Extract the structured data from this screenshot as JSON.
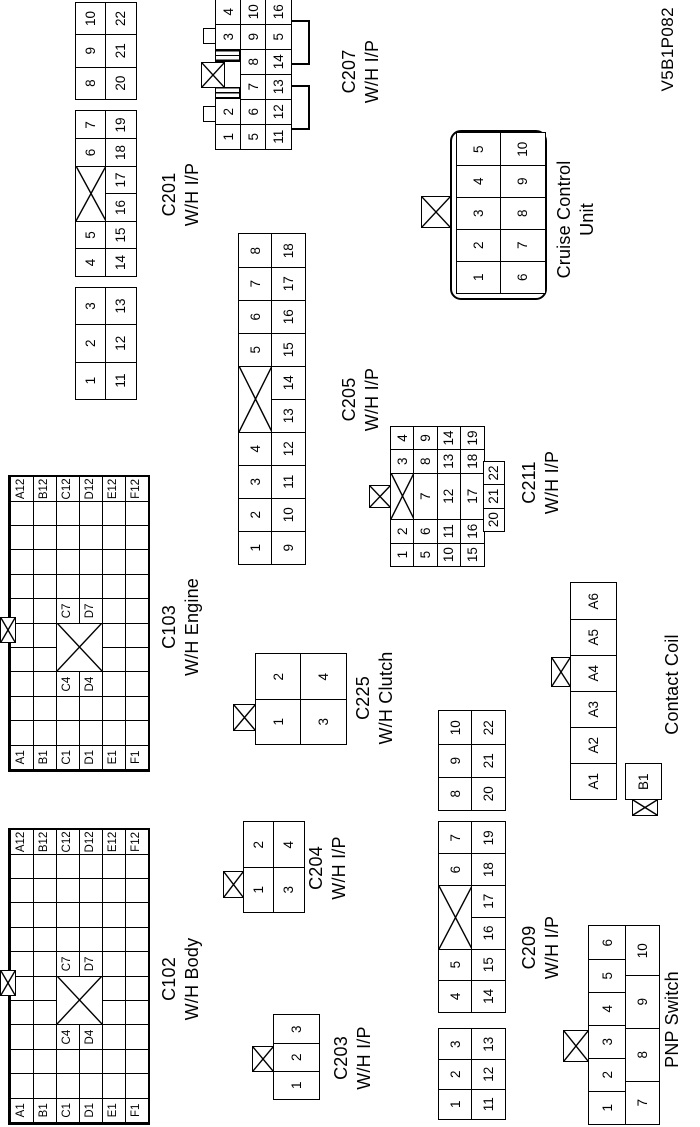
{
  "code": "V5B1P082",
  "connectors": {
    "c102": {
      "name": "C102",
      "sub": "W/H Body",
      "type": "grid",
      "cols": 12,
      "rows": 6,
      "cw": 24.4,
      "ch": 23,
      "cross": {
        "r": 2,
        "c": 4,
        "rs": 2,
        "cs": 2
      },
      "labels": [
        [
          0,
          0,
          "A1"
        ],
        [
          1,
          0,
          "B1"
        ],
        [
          2,
          0,
          "C1"
        ],
        [
          3,
          0,
          "D1"
        ],
        [
          4,
          0,
          "E1"
        ],
        [
          5,
          0,
          "F1"
        ],
        [
          0,
          11,
          "A12"
        ],
        [
          1,
          11,
          "B12"
        ],
        [
          2,
          11,
          "C12"
        ],
        [
          3,
          11,
          "D12"
        ],
        [
          4,
          11,
          "E12"
        ],
        [
          5,
          11,
          "F12"
        ],
        [
          2,
          3,
          "C4"
        ],
        [
          3,
          3,
          "D4"
        ],
        [
          2,
          6,
          "C7"
        ],
        [
          3,
          6,
          "D7"
        ]
      ]
    },
    "c103": {
      "name": "C103",
      "sub": "W/H Engine",
      "type": "grid",
      "cols": 12,
      "rows": 6,
      "cw": 24.4,
      "ch": 23,
      "cross": {
        "r": 2,
        "c": 4,
        "rs": 2,
        "cs": 2
      },
      "labels": [
        [
          0,
          0,
          "A1"
        ],
        [
          1,
          0,
          "B1"
        ],
        [
          2,
          0,
          "C1"
        ],
        [
          3,
          0,
          "D1"
        ],
        [
          4,
          0,
          "E1"
        ],
        [
          5,
          0,
          "F1"
        ],
        [
          0,
          11,
          "A12"
        ],
        [
          1,
          11,
          "B12"
        ],
        [
          2,
          11,
          "C12"
        ],
        [
          3,
          11,
          "D12"
        ],
        [
          4,
          11,
          "E12"
        ],
        [
          5,
          11,
          "F12"
        ],
        [
          2,
          3,
          "C4"
        ],
        [
          3,
          3,
          "D4"
        ],
        [
          2,
          6,
          "C7"
        ],
        [
          3,
          6,
          "D7"
        ]
      ]
    },
    "c201": {
      "name": "C201",
      "sub": "W/H I/P",
      "type": "blocks",
      "ch": 30,
      "blocks": [
        {
          "x": 0,
          "cw": 37.3,
          "rows": [
            [
              "1",
              "2",
              "3"
            ],
            [
              "11",
              "12",
              "13"
            ]
          ]
        },
        {
          "x": 123,
          "cw": 27.5,
          "rows": [
            [
              "4",
              "5",
              {
                "cross": true,
                "span": 2
              },
              "6",
              "7"
            ],
            [
              "14",
              "15",
              "16",
              "17",
              "18",
              "19"
            ]
          ]
        },
        {
          "x": 300,
          "cw": 32.3,
          "rows": [
            [
              "8",
              "9",
              "10"
            ],
            [
              "20",
              "21",
              "22"
            ]
          ]
        }
      ]
    },
    "c203": {
      "name": "C203",
      "sub": "W/H I/P",
      "type": "blocks",
      "ch": 45,
      "blocks": [
        {
          "x": 0,
          "cw": 28,
          "rows": [
            [
              "1",
              "2",
              "3"
            ]
          ]
        }
      ]
    },
    "c204": {
      "name": "C204",
      "sub": "W/H I/P",
      "type": "blocks",
      "ch": 30,
      "blocks": [
        {
          "x": 0,
          "cw": 45,
          "rows": [
            [
              "1",
              "2"
            ],
            [
              "3",
              "4"
            ]
          ]
        }
      ]
    },
    "c225": {
      "name": "C225",
      "sub": "W/H Clutch",
      "type": "blocks",
      "ch": 45,
      "blocks": [
        {
          "x": 0,
          "cw": 45,
          "rows": [
            [
              "1",
              "2"
            ],
            [
              "3",
              "4"
            ]
          ]
        }
      ]
    },
    "c205": {
      "name": "C205",
      "sub": "W/H I/P",
      "type": "blocks",
      "ch": 33,
      "blocks": [
        {
          "x": 0,
          "cw": 33,
          "rows": [
            [
              "1",
              "2",
              "3",
              "4",
              {
                "cross": true,
                "span": 2
              },
              "5",
              "6",
              "7",
              "8"
            ],
            [
              "9",
              "10",
              "11",
              "12",
              "13",
              "14",
              "15",
              "16",
              "17",
              "18"
            ]
          ]
        }
      ]
    },
    "c207": {
      "name": "C207",
      "sub": "W/H I/P",
      "type": "abs",
      "cw": 25,
      "ch": 25,
      "cells": [
        [
          "1",
          0,
          0
        ],
        [
          "2",
          25,
          0
        ],
        [
          "3",
          100,
          0
        ],
        [
          "4",
          125,
          0
        ],
        [
          "5",
          0,
          25
        ],
        [
          "6",
          25,
          25
        ],
        [
          "7",
          50,
          25
        ],
        [
          "8",
          75,
          25
        ],
        [
          "9",
          100,
          25
        ],
        [
          "10",
          125,
          25
        ],
        [
          "11",
          0,
          50
        ],
        [
          "12",
          25,
          50
        ],
        [
          "13",
          50,
          50
        ],
        [
          "14",
          75,
          50
        ],
        [
          "5",
          100,
          50
        ],
        [
          "16",
          125,
          50
        ]
      ]
    },
    "c209": {
      "name": "C209",
      "sub": "W/H I/P",
      "type": "blocks",
      "ch": 33,
      "blocks": [
        {
          "x": 0,
          "cw": 30,
          "rows": [
            [
              "1",
              "2",
              "3"
            ],
            [
              "11",
              "12",
              "13"
            ]
          ]
        },
        {
          "x": 107,
          "cw": 31.7,
          "rows": [
            [
              "4",
              "5",
              {
                "cross": true,
                "span": 2
              },
              "6",
              "7"
            ],
            [
              "14",
              "15",
              "16",
              "17",
              "18",
              "19"
            ]
          ]
        },
        {
          "x": 309,
          "cw": 33,
          "rows": [
            [
              "8",
              "9",
              "10"
            ],
            [
              "20",
              "21",
              "22"
            ]
          ]
        }
      ]
    },
    "c211": {
      "name": "C211",
      "sub": "W/H I/P",
      "type": "blocks",
      "ch": 23.3,
      "blocks": [
        {
          "x": 0,
          "cw": 23.3,
          "rows": [
            [
              "1",
              "2",
              {
                "cross": true,
                "w": 46.7
              },
              "3",
              "4"
            ],
            [
              "5",
              "6",
              {
                "t": "7",
                "w": 46.7
              },
              "8",
              "9"
            ],
            [
              "10",
              "11",
              {
                "t": "12",
                "w": 46.7
              },
              "13",
              "14"
            ],
            [
              "15",
              "16",
              {
                "t": "17",
                "w": 46.7
              },
              "18",
              "19"
            ]
          ]
        },
        {
          "x": 35,
          "y": 93.3,
          "ch": 20,
          "cw": 23.3,
          "rows": [
            [
              "20",
              "21",
              "22"
            ]
          ]
        }
      ]
    },
    "cruise": {
      "name": "Cruise Control",
      "sub": "Unit",
      "type": "blocks",
      "ch": 44,
      "blocks": [
        {
          "x": 4,
          "y": 4,
          "cw": 32,
          "rows": [
            [
              "1",
              "2",
              "3",
              "4",
              "5"
            ],
            [
              "6",
              "7",
              "8",
              "9",
              "10"
            ]
          ]
        }
      ]
    },
    "contact": {
      "name": "Contact Coil",
      "sub": "",
      "type": "blocks",
      "ch": 45,
      "blocks": [
        {
          "x": 0,
          "cw": 36,
          "rows": [
            [
              "A1",
              "A2",
              "A3",
              "A4",
              "A5",
              "A6"
            ]
          ]
        },
        {
          "x": 0,
          "y": 55,
          "cw": 35,
          "ch": 35,
          "rows": [
            [
              "B1"
            ]
          ]
        }
      ]
    },
    "pnp": {
      "name": "PNP Switch",
      "sub": "",
      "type": "blocks",
      "ch": 37,
      "blocks": [
        {
          "x": 0,
          "cw": 33,
          "rows": [
            [
              "1",
              "2",
              "3",
              "4",
              "5",
              "6"
            ]
          ]
        },
        {
          "x": 0,
          "y": 37,
          "ch": 33,
          "cw": 33,
          "rows": [
            [
              {
                "t": "7",
                "w": 43
              },
              {
                "t": "8",
                "w": 53
              },
              {
                "t": "9",
                "w": 53
              },
              {
                "t": "10",
                "w": 49
              }
            ]
          ]
        }
      ]
    }
  }
}
